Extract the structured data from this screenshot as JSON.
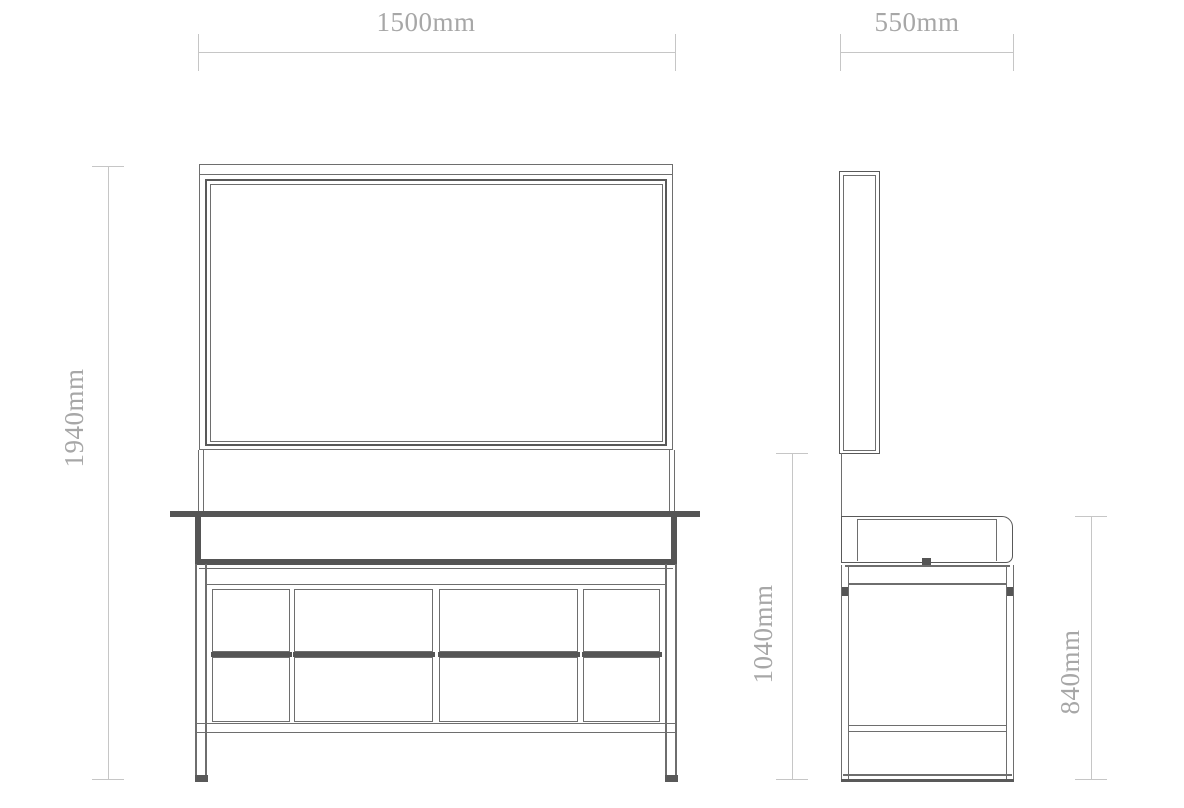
{
  "colors": {
    "line": "#6e6e6e",
    "line_strong": "#595959",
    "line_dark": "#555555",
    "dim_line": "#c6c6c6",
    "dim_text": "#a7a7a7",
    "background": "#ffffff"
  },
  "dimensions": {
    "front_width": "1500mm",
    "side_depth": "550mm",
    "overall_height": "1940mm",
    "mirror_bottom_height": "1040mm",
    "counter_height": "840mm"
  }
}
